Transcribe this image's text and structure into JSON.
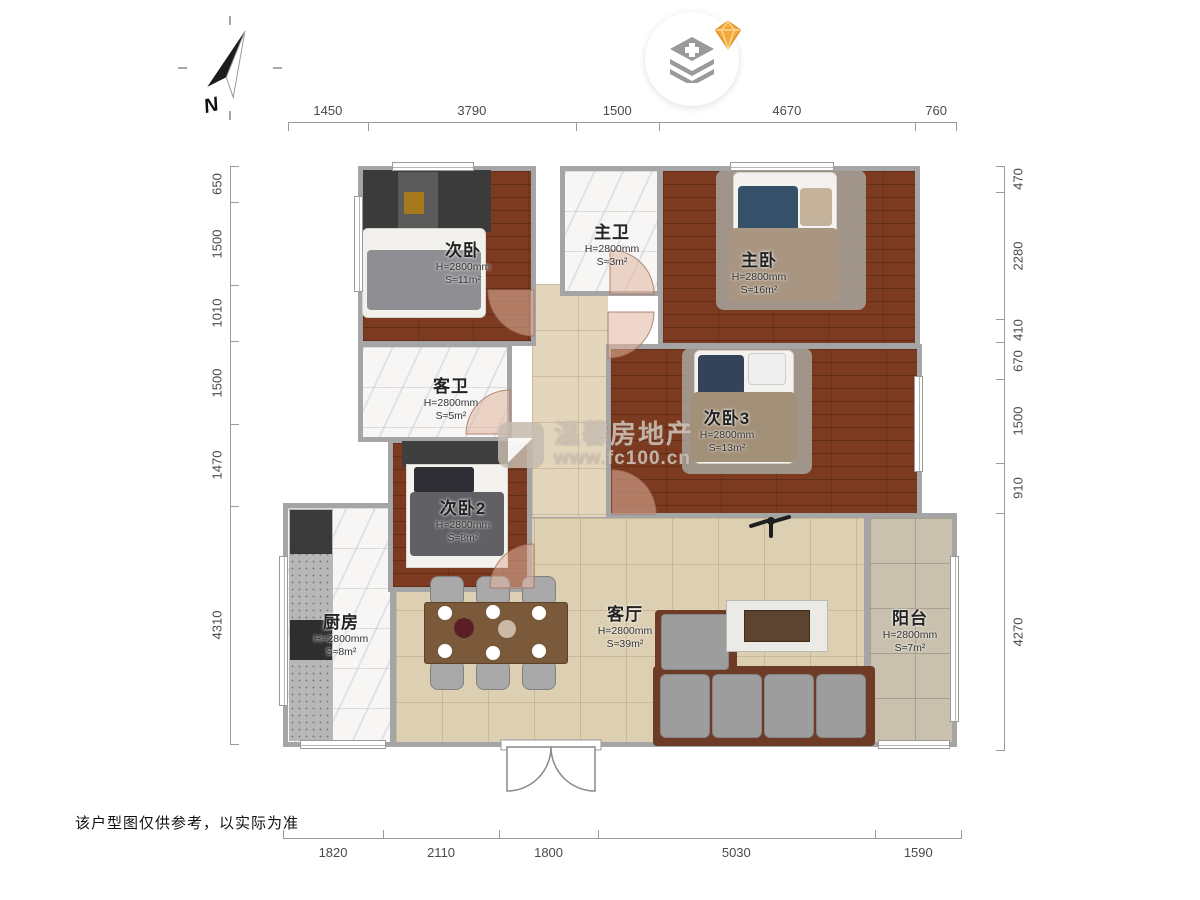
{
  "page": {
    "disclaimer": "该户型图仅供参考，以实际为准"
  },
  "compass": {
    "label": "N"
  },
  "badge": {
    "icon": "layers-plus-icon",
    "gem": "diamond-icon",
    "gem_color": "#f2a93b"
  },
  "watermark": {
    "brand": "温馨房地产",
    "url": "www.fc100.cn"
  },
  "dimensions": {
    "top": [
      1450,
      3790,
      1500,
      4670,
      760
    ],
    "bottom": [
      1820,
      2110,
      1800,
      5030,
      1590
    ],
    "left": [
      650,
      1500,
      1010,
      1500,
      1470,
      4310
    ],
    "right": [
      470,
      2280,
      410,
      670,
      1500,
      910,
      4270
    ]
  },
  "rooms": [
    {
      "id": "bed1",
      "name": "次卧",
      "height": "H=2800mm",
      "area": "S≈11m²"
    },
    {
      "id": "bath-master",
      "name": "主卫",
      "height": "H=2800mm",
      "area": "S≈3m²"
    },
    {
      "id": "master",
      "name": "主卧",
      "height": "H=2800mm",
      "area": "S≈16m²"
    },
    {
      "id": "bath-guest",
      "name": "客卫",
      "height": "H=2800mm",
      "area": "S≈5m²"
    },
    {
      "id": "bed3",
      "name": "次卧3",
      "height": "H=2800mm",
      "area": "S≈13m²"
    },
    {
      "id": "bed2",
      "name": "次卧2",
      "height": "H=2800mm",
      "area": "S≈8m²"
    },
    {
      "id": "kitchen",
      "name": "厨房",
      "height": "H=2800mm",
      "area": "S≈8m²"
    },
    {
      "id": "living",
      "name": "客厅",
      "height": "H=2800mm",
      "area": "S≈39m²"
    },
    {
      "id": "balcony",
      "name": "阳台",
      "height": "H=2800mm",
      "area": "S≈7m²"
    }
  ],
  "colors": {
    "wood_floor": "#7c3b20",
    "tile_floor": "#ddcfb2",
    "marble_floor": "#f7f6f4",
    "balcony_floor": "#c9c0ad",
    "wall": "#a5a5a5",
    "door_arc": "#e0b49e"
  }
}
